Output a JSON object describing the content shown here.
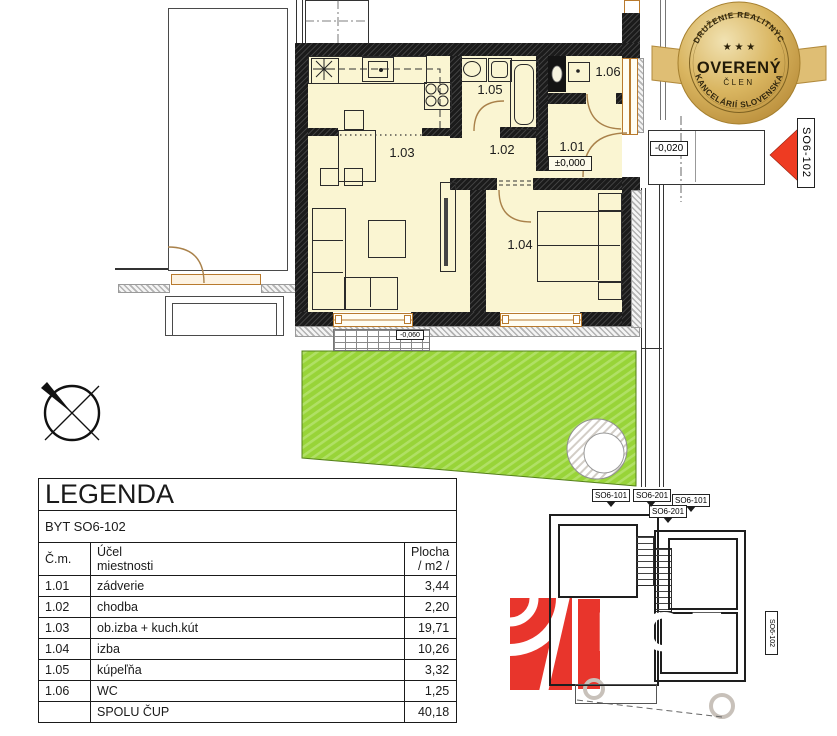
{
  "badge": {
    "arc_top": "ZDRUŽENIE REALITNÝCH",
    "arc_bottom": "KANCELÁRIÍ SLOVENSKA",
    "stars": "★ ★ ★",
    "title": "OVERENÝ",
    "subtitle": "ČLEN"
  },
  "plan": {
    "room_labels": [
      "1.01",
      "1.02",
      "1.03",
      "1.04",
      "1.05",
      "1.06"
    ],
    "levels": {
      "interior": "±0,000",
      "entrance": "-0,020",
      "terrace": "-0,060"
    },
    "unit_tag": "SO6-102"
  },
  "legend": {
    "title": "LEGENDA",
    "subtitle": "BYT SO6-102",
    "headers": {
      "num": "Č.m.",
      "purpose_line1": "Účel",
      "purpose_line2": "miestnosti",
      "area_line1": "Plocha",
      "area_line2": "/ m2 /"
    },
    "rows": [
      {
        "num": "1.01",
        "name": "zádverie",
        "area": "3,44"
      },
      {
        "num": "1.02",
        "name": "chodba",
        "area": "2,20"
      },
      {
        "num": "1.03",
        "name": "ob.izba + kuch.kút",
        "area": "19,71"
      },
      {
        "num": "1.04",
        "name": "izba",
        "area": "10,26"
      },
      {
        "num": "1.05",
        "name": "kúpeľňa",
        "area": "3,32"
      },
      {
        "num": "1.06",
        "name": "WC",
        "area": "1,25"
      }
    ],
    "total": {
      "num": "",
      "label": "SPOLU ČUP",
      "area": "40,18"
    }
  },
  "site_plan": {
    "labels": [
      "SO6-101",
      "SO6-201",
      "SO6-101",
      "SO6-201"
    ],
    "unit_tag": "SO6-102"
  },
  "watermark": {
    "text": "BCF"
  },
  "colors": {
    "floor": "#faf5d2",
    "wall": "#1b1b1b",
    "garden_green": "#98d438",
    "badge_gold": "#d4ab54",
    "accent_red": "#e8352c",
    "highlight_blue": "#bfe3f6",
    "window_orange": "#b87a2e"
  }
}
